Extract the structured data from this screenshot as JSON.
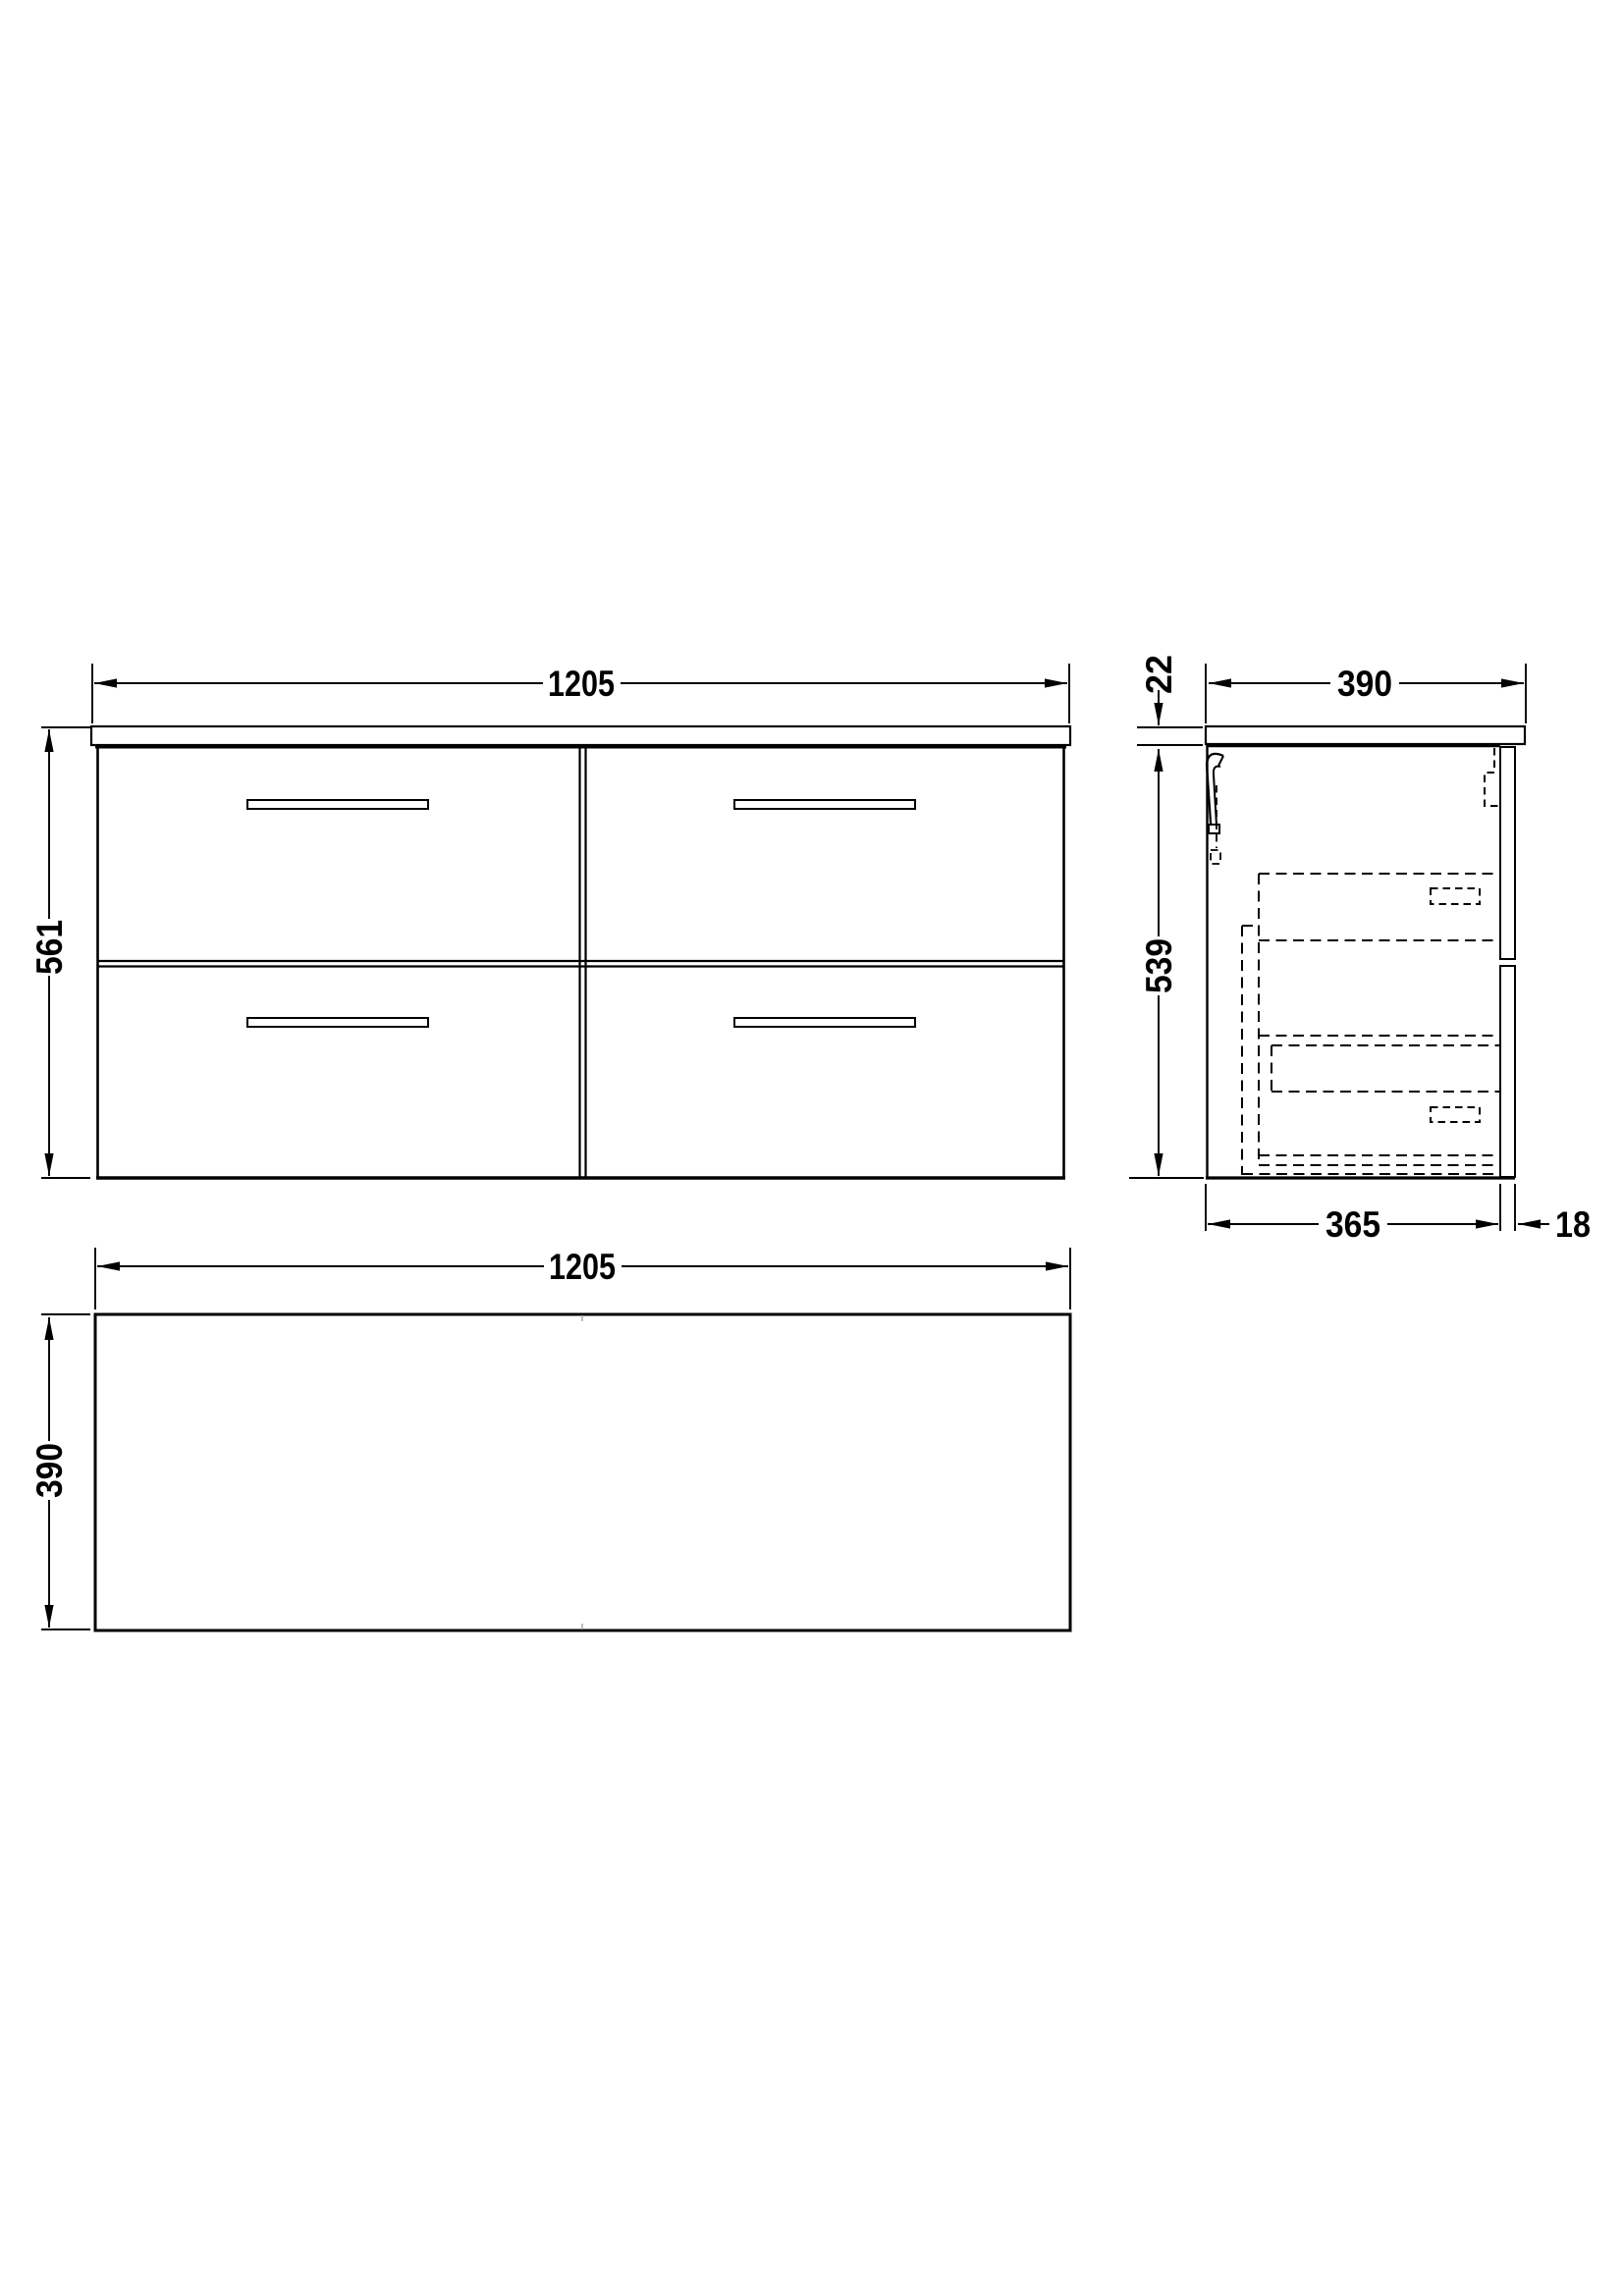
{
  "drawing": {
    "background_color": "#ffffff",
    "line_color": "#000000",
    "views": {
      "front": {
        "drawer_count": "4",
        "width_mm": "1205",
        "height_mm": "561"
      },
      "side": {
        "depth_mm": "390",
        "worktop_thickness_mm": "22",
        "body_height_mm": "539",
        "body_depth_mm": "365",
        "front_thickness_mm": "18"
      },
      "plan": {
        "width_mm": "1205",
        "depth_mm": "390"
      }
    }
  }
}
